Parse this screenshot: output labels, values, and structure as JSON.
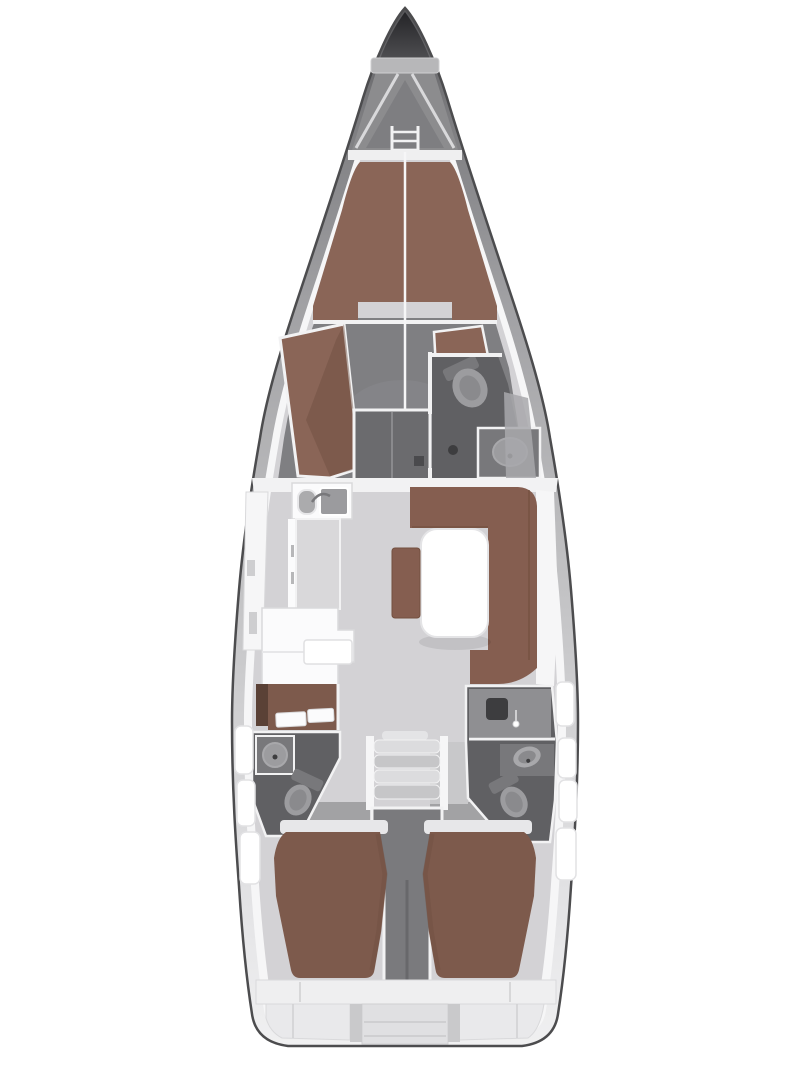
{
  "app": {
    "description": "Top-down interior floor plan of a sailing yacht",
    "type": "floor-plan"
  },
  "regions": [
    "anchor-locker",
    "forepeak",
    "bow-ladder",
    "forward-cabin-v-berth",
    "port-settee",
    "starboard-seat",
    "wardrobe",
    "forward-head",
    "galley",
    "salon-sofa",
    "salon-table",
    "salon-stool",
    "nav-station",
    "port-aft-head",
    "companionway-stairs",
    "engine-compartment",
    "starboard-aft-head",
    "port-aft-cabin-berth",
    "starboard-aft-cabin-berth",
    "transom-lockers",
    "swim-step",
    "hull-windows"
  ],
  "palette": {
    "background": "#ffffff",
    "hull_stroke": "#4c4c4e",
    "hull_g1": "#57575a",
    "hull_g2": "#7b7b7e",
    "hull_g3": "#a0a0a3",
    "hull_g4": "#bcbcbe",
    "hull_g5": "#d4d4d6",
    "hull_g6": "#e7e7e9",
    "hull_g7": "#f0f0f1",
    "lining": "#f6f6f7",
    "floor": "#d3d2d5",
    "fwd_floor": "#7f7f82",
    "fwd_floor_light": "#8a8a8d",
    "room_dark": "#606063",
    "shower_floor": "#8f8f92",
    "wardrobe": "#6b6b6e",
    "locker_tip_dark": "#242427",
    "locker_tip_mid": "#515154",
    "locker_mid": "#8c8c8e",
    "shelf_bar": "#b7b7b9",
    "v_dark": "#7e7e81",
    "wall": "#f2f2f3",
    "band": "#efeff0",
    "berth_fwd": "#8a6557",
    "berth_shade": "#6d4d40",
    "sofa": "#855e50",
    "sofa_shade": "#73503f",
    "berth_aft": "#7d5a4c",
    "trim_brown": "#5a4136",
    "furn_white": "#fbfbfc",
    "furn_stroke": "#d9d9db",
    "counter_top": "#d9d8da",
    "fixture": "#9c9c9f",
    "fixture_inner": "#8a8a8d",
    "fixture_light": "#a8a8ab",
    "fixture_dark": "#78787b",
    "drain": "#3d3d3f",
    "step1": "#dcdcde",
    "step2": "#c6c6c8",
    "step_top": "#e4e4e6",
    "engine": "#7a7a7d",
    "engine_dark": "#68686b",
    "window": "#ffffff",
    "window_stroke": "#e2e2e4",
    "entry": "#a2a2a4",
    "corridor": "#c8c8ca",
    "rim": "#e7e7e9",
    "transom": "#e9e9eb",
    "transom_recess": "#e0e0e2",
    "divider": "#c9c9cb",
    "seam": "#cfcfd1",
    "table_white": "#ffffff",
    "table_stroke": "#e4e4e6",
    "sink_l": "#ababad",
    "sink_r": "#9b9b9e",
    "white": "#ffffff",
    "knob_dark": "#4a4a4d",
    "spacer": "#c4c4c6"
  }
}
